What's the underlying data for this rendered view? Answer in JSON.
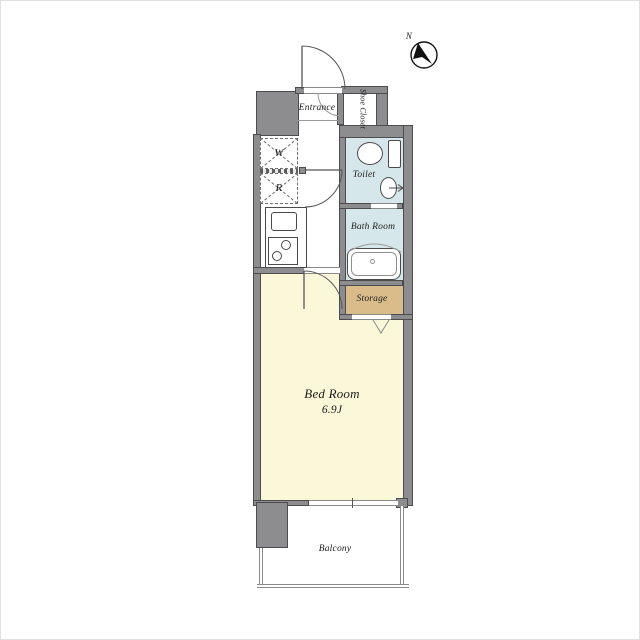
{
  "compass": {
    "label": "N"
  },
  "rooms": {
    "entrance": {
      "label": "Entrance"
    },
    "shoe_closet": {
      "label": "Shoe Closet"
    },
    "toilet": {
      "label": "Toilet"
    },
    "bath": {
      "label": "Bath Room"
    },
    "storage": {
      "label": "Storage"
    },
    "bedroom": {
      "label": "Bed Room",
      "size": "6.9J"
    },
    "balcony": {
      "label": "Balcony"
    }
  },
  "appliances": {
    "washer": {
      "label": "W"
    },
    "refrigerator": {
      "label": "R"
    }
  },
  "colors": {
    "wall": "#8d8d8f",
    "wall_outline": "#4c4c4e",
    "wet_area": "#d6e7eb",
    "bedroom": "#fbf8da",
    "storage": "#d9bc8a",
    "floor_white": "#ffffff",
    "line": "#555555",
    "text": "#1c1c1c"
  }
}
